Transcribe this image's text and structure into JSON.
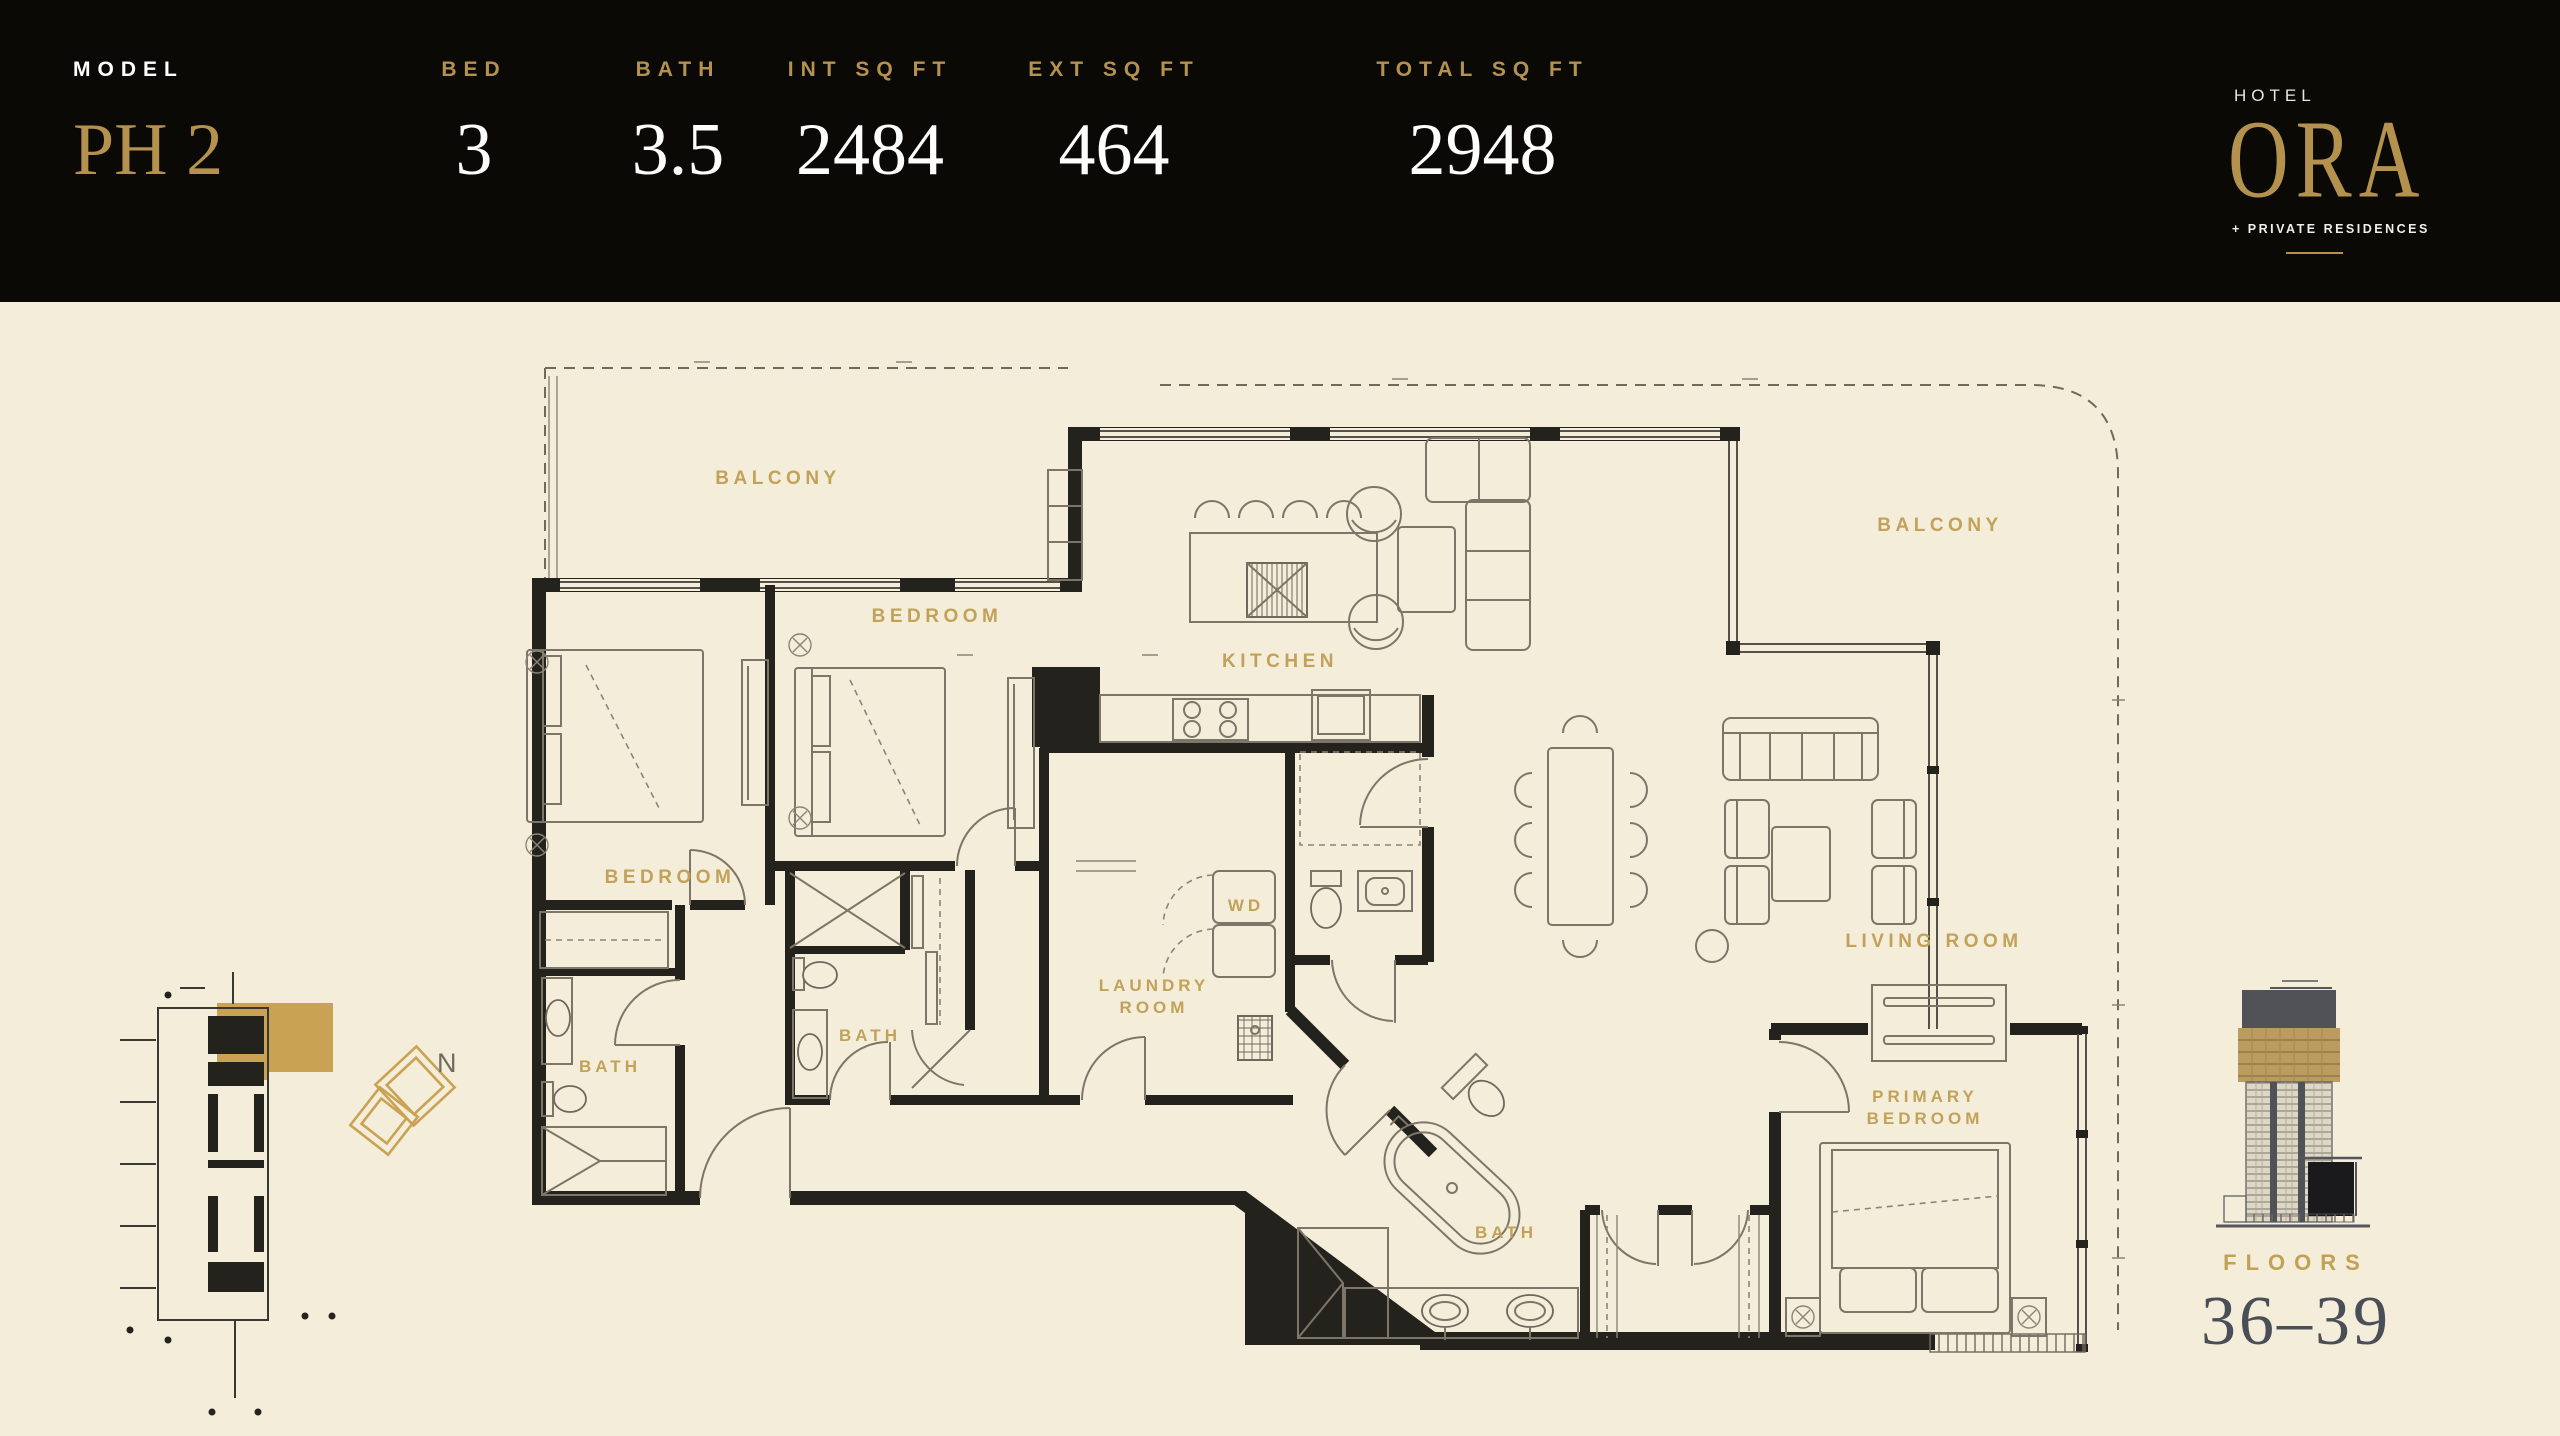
{
  "header": {
    "stats": [
      {
        "label": "MODEL",
        "value": "PH 2"
      },
      {
        "label": "BED",
        "value": "3"
      },
      {
        "label": "BATH",
        "value": "3.5"
      },
      {
        "label": "INT SQ FT",
        "value": "2484"
      },
      {
        "label": "EXT SQ FT",
        "value": "464"
      },
      {
        "label": "TOTAL SQ FT",
        "value": "2948"
      }
    ],
    "logo": {
      "top": "HOTEL",
      "name": "ORA",
      "tagline": "+ PRIVATE RESIDENCES"
    }
  },
  "floorplan": {
    "labels": {
      "balcony_left": "BALCONY",
      "balcony_right": "BALCONY",
      "bedroom_left": "BEDROOM",
      "bedroom_mid": "BEDROOM",
      "kitchen": "KITCHEN",
      "living_room": "LIVING ROOM",
      "wd": "WD",
      "laundry_line1": "LAUNDRY",
      "laundry_line2": "ROOM",
      "bath_left": "BATH",
      "bath_mid": "BATH",
      "bath_primary": "BATH",
      "primary_line1": "PRIMARY",
      "primary_line2": "BEDROOM"
    }
  },
  "keyplan": {
    "north": "N"
  },
  "building": {
    "label": "FLOORS",
    "range": "36–39"
  },
  "colors": {
    "background": "#f4edda",
    "header_bg": "#0a0906",
    "accent_gold": "#b5914e",
    "label_gold": "#c2a258",
    "wall": "#24221d",
    "floors_text": "#4a4f57"
  }
}
